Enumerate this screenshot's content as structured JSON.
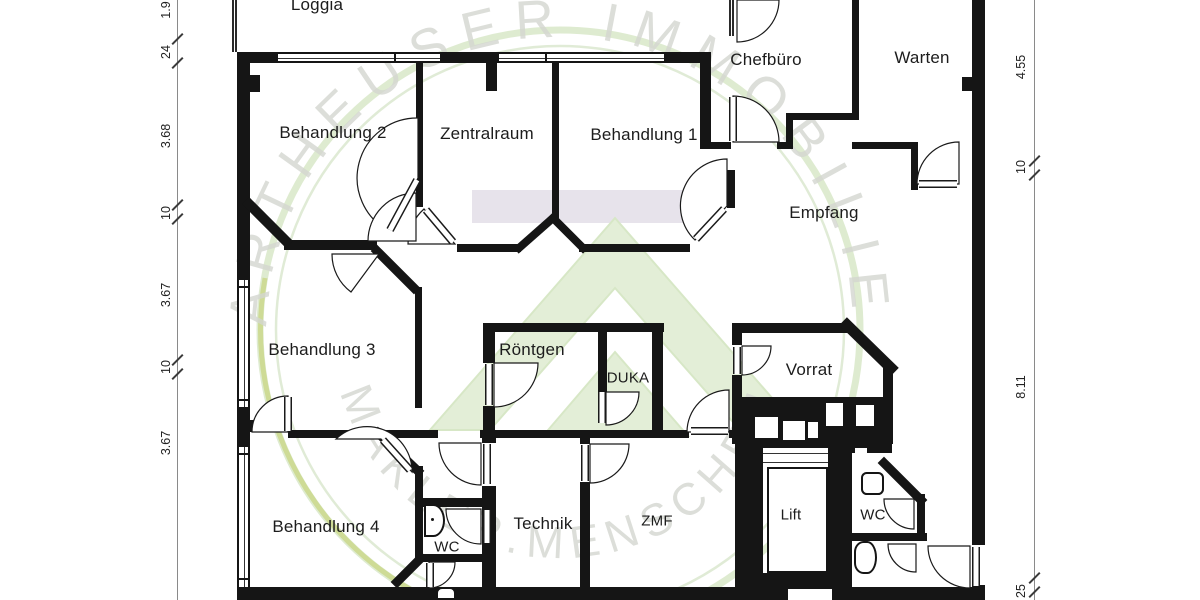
{
  "title": "Praxis Grundriss / floor plan",
  "rooms": {
    "loggia": "Loggia",
    "behandlung2": "Behandlung 2",
    "zentralraum": "Zentralraum",
    "behandlung1": "Behandlung 1",
    "chefbuero": "Chefbüro",
    "warten": "Warten",
    "empfang": "Empfang",
    "behandlung3": "Behandlung 3",
    "roentgen": "Röntgen",
    "duka": "DUKA",
    "vorrat": "Vorrat",
    "behandlung4": "Behandlung 4",
    "wc_left": "WC",
    "technik": "Technik",
    "zmf": "ZMF",
    "lift": "Lift",
    "wc_right": "WC"
  },
  "dimensions": {
    "left": [
      "1.9",
      "24",
      "3.68",
      "10",
      "3.67",
      "10",
      "3.67"
    ],
    "right": [
      "4.55",
      "10",
      "8.11",
      "25"
    ]
  },
  "watermark": {
    "line1": "KARTHEUSER IMMOBILIEN",
    "line2": "MAKLER.MENSCHEN",
    "ring_color": "#d8e7c8",
    "accent_color": "#ccd98f",
    "text_color": "#d3d6cf",
    "logo_color": "#e3eed7"
  },
  "colors": {
    "wall": "#151515",
    "corridor_band": "#e7e3eb",
    "background": "#ffffff"
  }
}
